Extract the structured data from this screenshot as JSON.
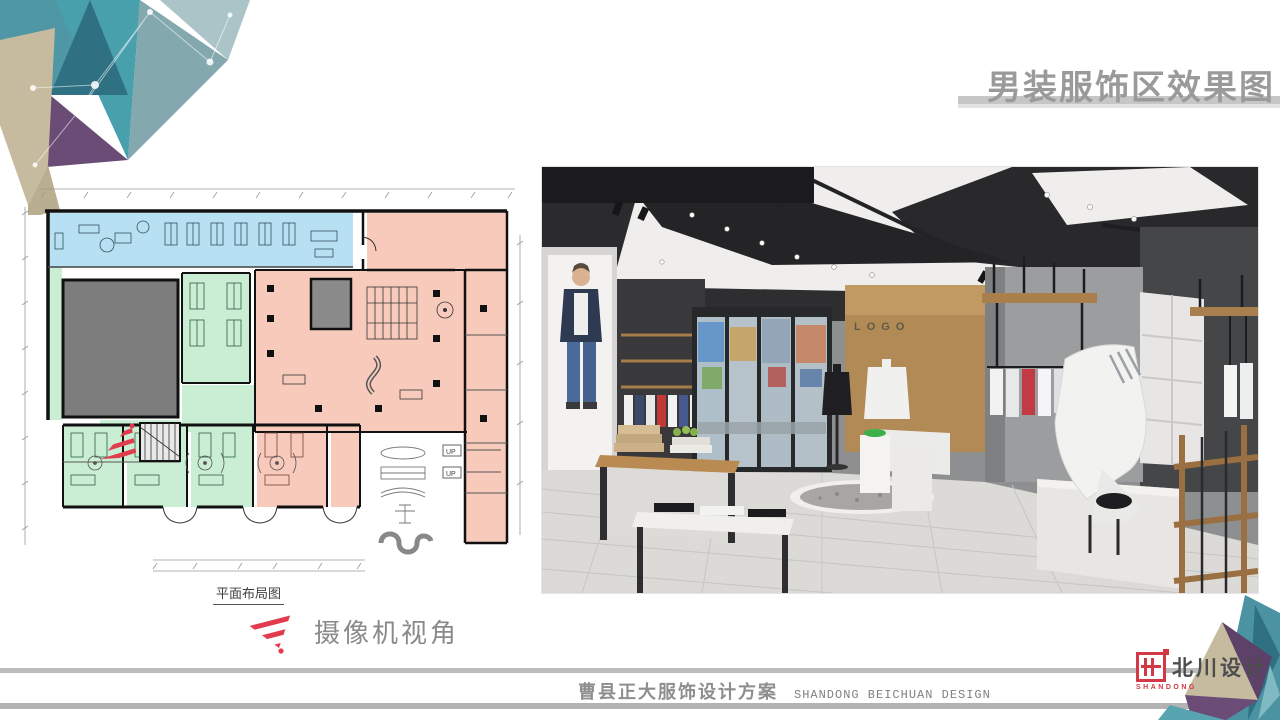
{
  "slide": {
    "title": "男装服饰区效果图",
    "footer": {
      "project_cn": "曹县正大服饰设计方案",
      "company_en": "SHANDONG BEICHUAN DESIGN"
    },
    "brand": {
      "name_cn": "北川设计",
      "sub_en": "SHANDONG"
    }
  },
  "floor_plan": {
    "label": "平面布局图",
    "camera_view_label": "摄像机视角",
    "legend_up_label": "UP",
    "zone_colors": {
      "circulation_blue": "#b7e0f3",
      "rooms_green": "#c9eed3",
      "retail_pink": "#f7cabc",
      "core_gray": "#7d7d7d",
      "walls": "#1a1a1a",
      "camera_marker_red": "#e23b4e"
    }
  },
  "render": {
    "logo_text": "LOGO"
  },
  "colors": {
    "title_gray": "#9a9a9a",
    "underline_gray": "#c6c6c6",
    "footer_bar_gray": "#b3b3b3",
    "accent_red": "#d43845",
    "deco_teal": "#4f97a5",
    "deco_dark_teal": "#2f7183",
    "deco_purple": "#6a4c77",
    "deco_beige": "#c6bb9e"
  }
}
